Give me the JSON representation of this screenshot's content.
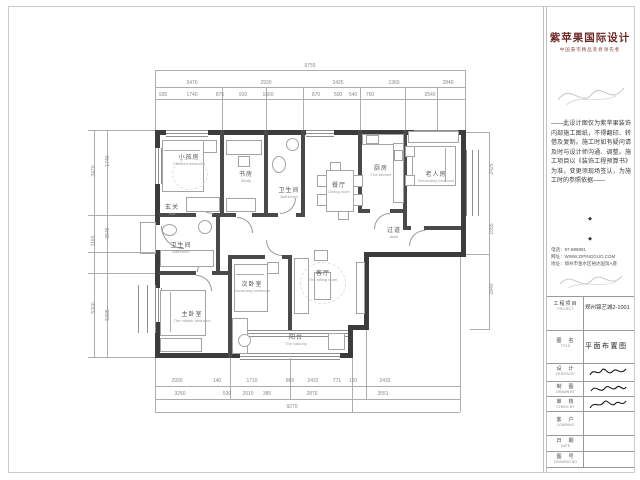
{
  "brand": {
    "logo": "紫苹果国际设计",
    "slogan": "中国豪宅精品装修领先者"
  },
  "notes": "——此设计图仅为紫苹果装饰内部施工图纸，不得翻印、转借及复制。施工时如有疑问请及时与设计师沟通、调整。施工项目以《装饰工程预算书》为准，变更须现场签认，为施工时的参照依据——",
  "bullets": [
    "◆",
    "◆"
  ],
  "contact": {
    "phone": "电话：87-888881",
    "web": "网址：WWW.ZIPINGGUO.COM",
    "addr": "地址：郑州市金水区裕达国贸A座"
  },
  "titleblock": {
    "project_label": "工程项目",
    "project_en": "PROJECT",
    "project_value": "郑州锦艺城2-1001",
    "title_label": "图　名",
    "title_en": "TITLE",
    "title_value": "平面布置图",
    "design_label": "设　计",
    "design_en": "DESIGN BY",
    "draw_label": "制　图",
    "draw_en": "DRAWN BY",
    "check_label": "审　核",
    "check_en": "CHECK BY",
    "client_label": "客　户",
    "client_en": "COMPANY",
    "date_label": "日　期",
    "date_en": "DATE",
    "no_label": "图　号",
    "no_en": "DRAWING NO"
  },
  "rooms": [
    {
      "cn": "小孩房",
      "en": "Children bedroom"
    },
    {
      "cn": "书房",
      "en": "Study"
    },
    {
      "cn": "卫生间",
      "en": "Bathroom"
    },
    {
      "cn": "餐厅",
      "en": "Dining room"
    },
    {
      "cn": "厨房",
      "en": "The kitchen"
    },
    {
      "cn": "老人房",
      "en": "Secondary bedroom"
    },
    {
      "cn": "过道",
      "en": "Aisle"
    },
    {
      "cn": "玄关",
      "en": "Hall"
    },
    {
      "cn": "卫生间",
      "en": "Bathroom"
    },
    {
      "cn": "主卧室",
      "en": "The master bedroom"
    },
    {
      "cn": "次卧室",
      "en": "Secondary bedroom"
    },
    {
      "cn": "客厅",
      "en": "The sitting room"
    },
    {
      "cn": "阳台",
      "en": "The balcony"
    }
  ],
  "dims": {
    "top_total": "9755",
    "top_row1": [
      "3470",
      "2930",
      "2425",
      "1360",
      "2840"
    ],
    "top_row2": [
      "935",
      "1740",
      "875",
      "910",
      "1660",
      "870",
      "500",
      "540",
      "760",
      "2540"
    ],
    "bottom_row1": [
      "2930",
      "140",
      "1710",
      "865",
      "2432",
      "771",
      "120",
      "2433"
    ],
    "bottom_row2": [
      "3250",
      "530",
      "2010",
      "385",
      "2876",
      "3551"
    ],
    "bottom_total": "9270",
    "left_outer": [
      "3470",
      "1165",
      "5300"
    ],
    "left_inner": [
      "1740",
      "3545",
      "5305"
    ],
    "right_col": [
      "2425",
      "1055",
      "2840"
    ]
  }
}
